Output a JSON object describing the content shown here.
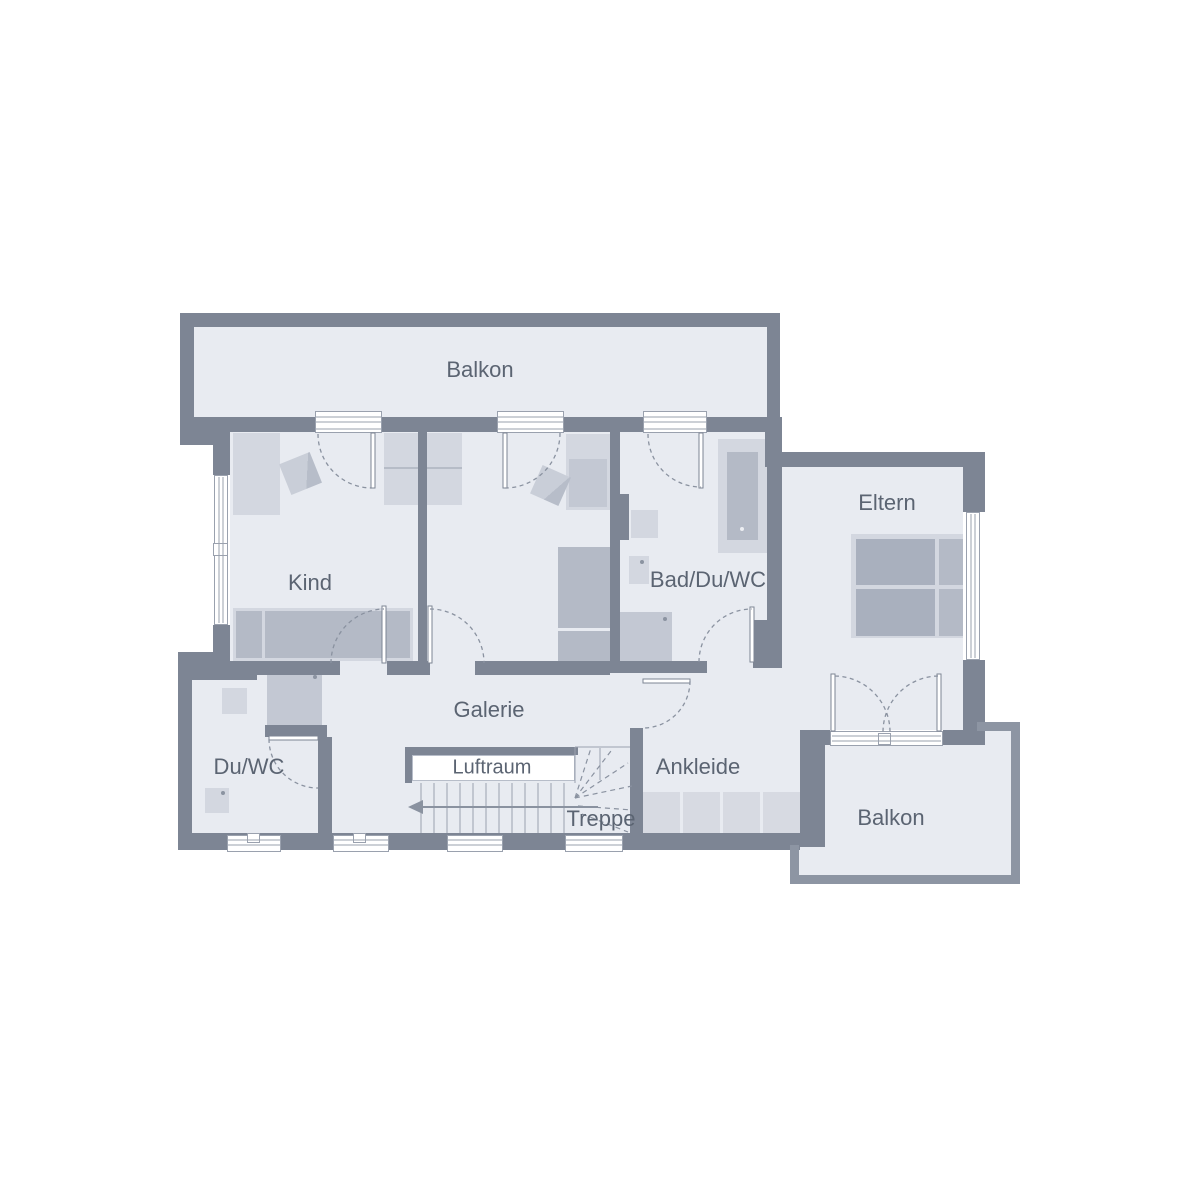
{
  "palette": {
    "background": "#ffffff",
    "wall": "#7d8594",
    "balcony_wall": "#8d95a3",
    "room_fill": "#e8ebf1",
    "furniture_light": "#d3d7e0",
    "furniture_medium": "#c3c8d3",
    "furniture_dark": "#b4bac6",
    "mattress": "#a9b0be",
    "stair_line": "#9aa1ae",
    "door_arc": "#8a92a0",
    "label_text": "#5b6472"
  },
  "rooms": {
    "balkon_top": {
      "label": "Balkon"
    },
    "kind": {
      "label": "Kind"
    },
    "bad": {
      "label": "Bad/Du/WC"
    },
    "eltern": {
      "label": "Eltern"
    },
    "du_wc": {
      "label": "Du/WC"
    },
    "galerie": {
      "label": "Galerie"
    },
    "luftraum": {
      "label": "Luftraum"
    },
    "treppe": {
      "label": "Treppe"
    },
    "ankleide": {
      "label": "Ankleide"
    },
    "balkon_bottom": {
      "label": "Balkon"
    }
  }
}
